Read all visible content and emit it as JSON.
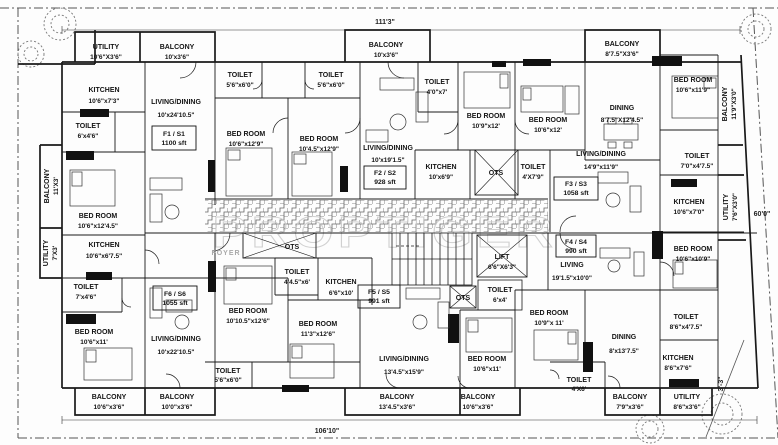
{
  "watermark": "PROPTIGER",
  "site": {
    "dim_top": "111'3\"",
    "dim_bottom": "106'10\"",
    "dim_right": "60'0\"",
    "dim_corner": "3'-3\""
  },
  "core": {
    "foyer": "FOYER",
    "ots": "OTS",
    "lift": "LIFT",
    "lift_dims": "6'6\"X6'3\""
  },
  "flats": {
    "f1": {
      "id": "F1 / S1",
      "area": "1100 sft"
    },
    "f2": {
      "id": "F2 / S2",
      "area": "928 sft"
    },
    "f3": {
      "id": "F3 / S3",
      "area": "1058 sft"
    },
    "f4": {
      "id": "F4 / S4",
      "area": "990 sft"
    },
    "f5": {
      "id": "F5 / S5",
      "area": "991 sft"
    },
    "f6": {
      "id": "F6 / S6",
      "area": "1055 sft"
    }
  },
  "rooms": {
    "utility_tl": {
      "name": "UTILITY",
      "dims": "10'6\"X3'6\""
    },
    "balcony_tl": {
      "name": "BALCONY",
      "dims": "10'x3'6\""
    },
    "kitchen_f1": {
      "name": "KITCHEN",
      "dims": "10'6\"x7'3\""
    },
    "toilet_f1a": {
      "name": "TOILET",
      "dims": "6'x4'6\""
    },
    "living_f1": {
      "name": "LIVING/DINING",
      "dims": "10'x24'10.5\""
    },
    "toilet_f1b": {
      "name": "TOILET",
      "dims": "5'6\"x6'0\""
    },
    "bed_f1a": {
      "name": "BED ROOM",
      "dims": "10'6\"x12'9\""
    },
    "bed_f1b": {
      "name": "BED ROOM",
      "dims": "10'4.5\"x12'9\""
    },
    "toilet_f2a": {
      "name": "TOILET",
      "dims": "5'6\"x6'0\""
    },
    "balcony_tc": {
      "name": "BALCONY",
      "dims": "10'x3'6\""
    },
    "living_f2": {
      "name": "LIVING/DINING",
      "dims": "10'x19'1.5\""
    },
    "toilet_f2b": {
      "name": "TOILET",
      "dims": "4'0\"x7'"
    },
    "bed_f2": {
      "name": "BED ROOM",
      "dims": "10'9\"x12'"
    },
    "kitchen_f2": {
      "name": "KITCHEN",
      "dims": "10'x6'9\""
    },
    "toilet_f3a": {
      "name": "TOILET",
      "dims": "4'X7'9\""
    },
    "bed_f3a": {
      "name": "BED ROOM",
      "dims": "10'6\"x12'"
    },
    "balcony_tr": {
      "name": "BALCONY",
      "dims": "8'7.5\"X3'6\""
    },
    "bed_f3b": {
      "name": "BED ROOM",
      "dims": "10'6\"x11'9\""
    },
    "balcony_r": {
      "name": "BALCONY",
      "dims": "11'9\"X3'0\""
    },
    "dining_f3": {
      "name": "DINING",
      "dims": "8'7.5\"X12'4.5\""
    },
    "toilet_f3b": {
      "name": "TOILET",
      "dims": "7'0\"x4'7.5\""
    },
    "kitchen_f3": {
      "name": "KITCHEN",
      "dims": "10'6\"x7'0\""
    },
    "utility_r": {
      "name": "UTILITY",
      "dims": "7'6\"X3'0\""
    },
    "living_f3": {
      "name": "LIVING/DINING",
      "dims": "14'9\"x11'9\""
    },
    "balcony_l": {
      "name": "BALCONY",
      "dims": "11'X3'"
    },
    "bed_l": {
      "name": "BED ROOM",
      "dims": "10'6\"x12'4.5\""
    },
    "utility_l": {
      "name": "UTILITY",
      "dims": "7'X3'"
    },
    "kitchen_f6": {
      "name": "KITCHEN",
      "dims": "10'6\"x6'7.5\""
    },
    "toilet_f6": {
      "name": "TOILET",
      "dims": "7'x4'6\""
    },
    "bed_f6a": {
      "name": "BED ROOM",
      "dims": "10'6\"x11'"
    },
    "living_f6": {
      "name": "LIVING/DINING",
      "dims": "10'x22'10.5\""
    },
    "bed_f6b": {
      "name": "BED ROOM",
      "dims": "10'10.5\"x12'6\""
    },
    "toilet_f5a": {
      "name": "TOILET",
      "dims": "4'4.5\"x6'"
    },
    "kitchen_f5": {
      "name": "KITCHEN",
      "dims": "6'6\"x10'"
    },
    "bed_f5a": {
      "name": "BED ROOM",
      "dims": "11'3\"x12'6\""
    },
    "living_f5": {
      "name": "LIVING/DINING",
      "dims": "13'4.5\"x15'9\""
    },
    "toilet_f5b": {
      "name": "TOILET",
      "dims": "6'x4'"
    },
    "bed_f5b": {
      "name": "BED ROOM",
      "dims": "10'6\"x11'"
    },
    "living_f4": {
      "name": "LIVING",
      "dims": "19'1.5\"x10'0\""
    },
    "bed_f4a": {
      "name": "BED ROOM",
      "dims": "10'6\"x10'9\""
    },
    "bed_f4b": {
      "name": "BED ROOM",
      "dims": "10'9\"x 11'"
    },
    "dining_f4": {
      "name": "DINING",
      "dims": "8'x13'7.5\""
    },
    "toilet_f4a": {
      "name": "TOILET",
      "dims": "8'6\"x4'7.5\""
    },
    "kitchen_f4": {
      "name": "KITCHEN",
      "dims": "8'6\"x7'6\""
    },
    "toilet_f4b": {
      "name": "TOILET",
      "dims": "4'X6'"
    },
    "balcony_b1": {
      "name": "BALCONY",
      "dims": "10'6\"x3'6\""
    },
    "balcony_b2": {
      "name": "BALCONY",
      "dims": "10'0\"x3'6\""
    },
    "toilet_b": {
      "name": "TOILET",
      "dims": "5'6\"x6'0\""
    },
    "balcony_b3": {
      "name": "BALCONY",
      "dims": "13'4.5\"x3'6\""
    },
    "balcony_b4": {
      "name": "BALCONY",
      "dims": "10'6\"x3'6\""
    },
    "balcony_b5": {
      "name": "BALCONY",
      "dims": "7'9\"x3'6\""
    },
    "utility_b": {
      "name": "UTILITY",
      "dims": "8'6\"x3'6\""
    }
  }
}
